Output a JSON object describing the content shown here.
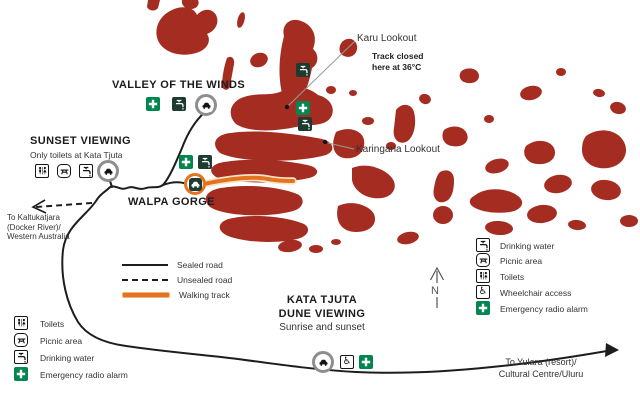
{
  "map": {
    "valley_label": "VALLEY OF THE WINDS",
    "sunset": {
      "title": "SUNSET VIEWING",
      "subtitle": "Only toilets at Kata Tjuta"
    },
    "walpa_label": "WALPA GORGE",
    "karu": {
      "label": "Karu Lookout",
      "warning_line1": "Track closed",
      "warning_line2": "here at 36°C"
    },
    "karingana_label": "Karingana Lookout",
    "dune": {
      "line1": "KATA TJUTA",
      "line2": "DUNE VIEWING",
      "line3": "Sunrise and sunset"
    },
    "west_sign": {
      "line1": "To Kaltukatjara",
      "line2": "(Docker River)/",
      "line3": "Western Australia"
    },
    "east_sign": {
      "line1": "To Yulara (resort)/",
      "line2": "Cultural Centre/Uluru"
    },
    "north_label": "N"
  },
  "legend": {
    "roads": [
      {
        "icon": "sealed-road-swatch",
        "label": "Sealed road"
      },
      {
        "icon": "unsealed-road-swatch",
        "label": "Unsealed road"
      },
      {
        "icon": "walking-track-swatch",
        "label": "Walking track"
      }
    ],
    "right": [
      {
        "icon": "drinking-water-icon",
        "label": "Drinking water"
      },
      {
        "icon": "picnic-area-icon",
        "label": "Picnic area"
      },
      {
        "icon": "toilets-icon",
        "label": "Toilets"
      },
      {
        "icon": "wheelchair-access-icon",
        "label": "Wheelchair access"
      },
      {
        "icon": "emergency-radio-alarm-icon",
        "label": "Emergency radio alarm"
      }
    ],
    "bottom_left": [
      {
        "icon": "toilets-icon",
        "label": "Toilets"
      },
      {
        "icon": "picnic-area-icon",
        "label": "Picnic area"
      },
      {
        "icon": "drinking-water-icon",
        "label": "Drinking water"
      },
      {
        "icon": "emergency-radio-alarm-icon",
        "label": "Emergency radio alarm"
      }
    ]
  },
  "icons": {
    "wheelchair_glyph": "♿"
  },
  "colors": {
    "rock": "#A42C20",
    "road": "#1d1d1d",
    "walking_track": "#E4731F",
    "emergency_green": "#00864F",
    "marker_ring_gray": "#8E8E8E",
    "marker_ring_orange": "#E4731F",
    "dark_icon": "#1E3B31"
  }
}
